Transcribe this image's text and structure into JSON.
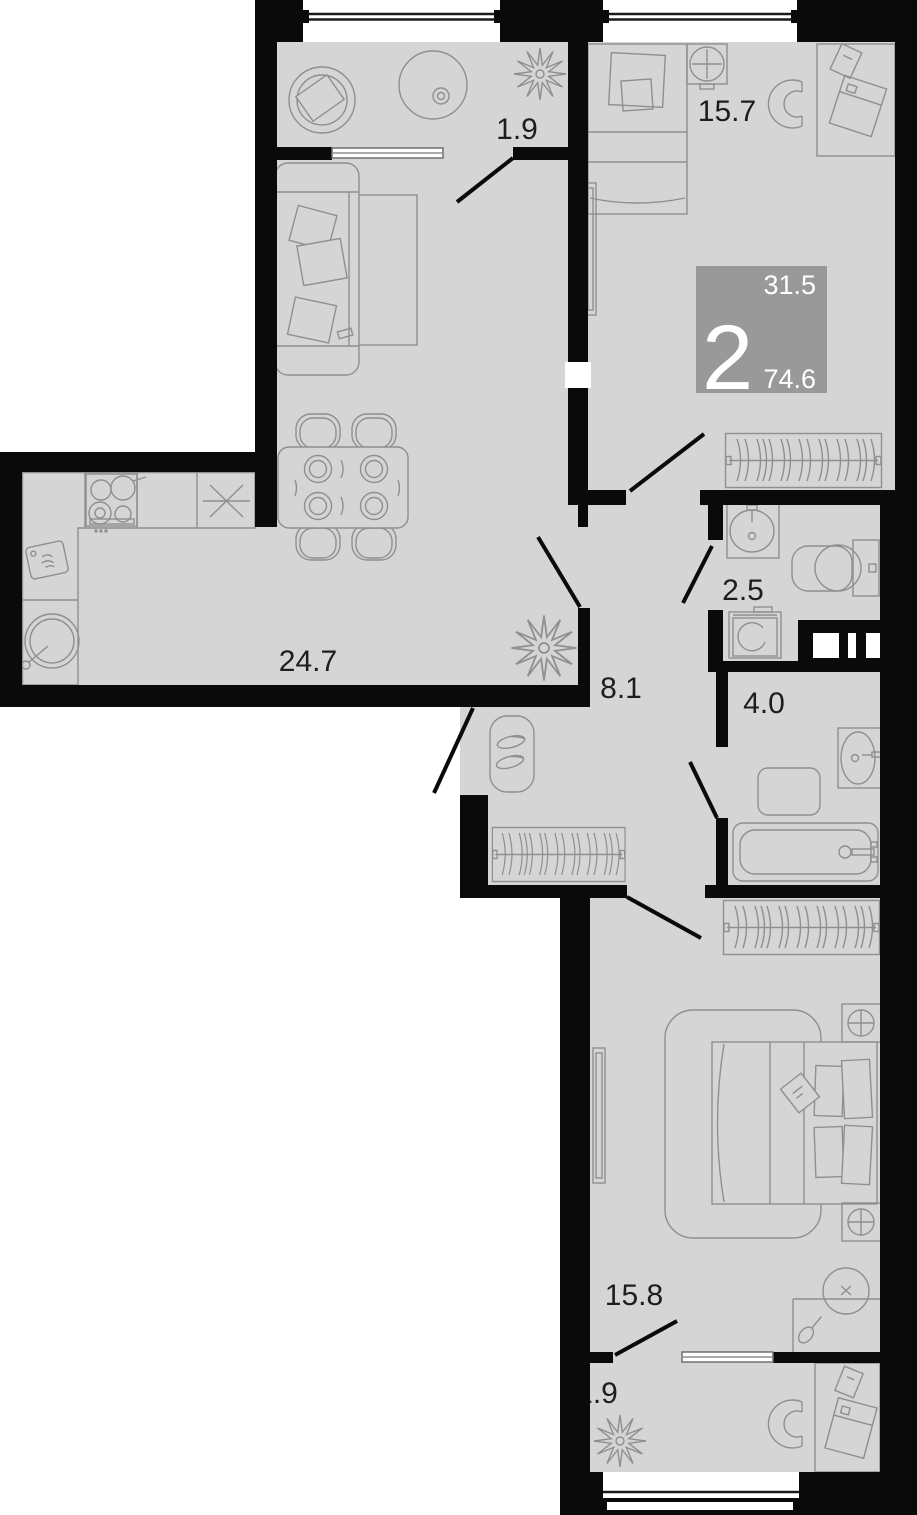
{
  "plan": {
    "type": "apartment-floor-plan",
    "badge": {
      "rooms": "2",
      "living_area": "31.5",
      "total_area": "74.6",
      "bg": "#999999",
      "text_color": "#ffffff"
    },
    "rooms": [
      {
        "id": "balcony-top",
        "label": "1.9"
      },
      {
        "id": "bedroom-1",
        "label": "15.7"
      },
      {
        "id": "wc",
        "label": "2.5"
      },
      {
        "id": "hallway",
        "label": "8.1"
      },
      {
        "id": "bathroom",
        "label": "4.0"
      },
      {
        "id": "kitchen-living",
        "label": "24.7"
      },
      {
        "id": "bedroom-2",
        "label": "15.8"
      },
      {
        "id": "balcony-bottom",
        "label": "1.9"
      }
    ],
    "colors": {
      "wall": "#0a0a0a",
      "floor": "#d5d5d5",
      "furniture": "#8f8f8f",
      "label": "#1d1d1d",
      "background": "#ffffff"
    }
  }
}
